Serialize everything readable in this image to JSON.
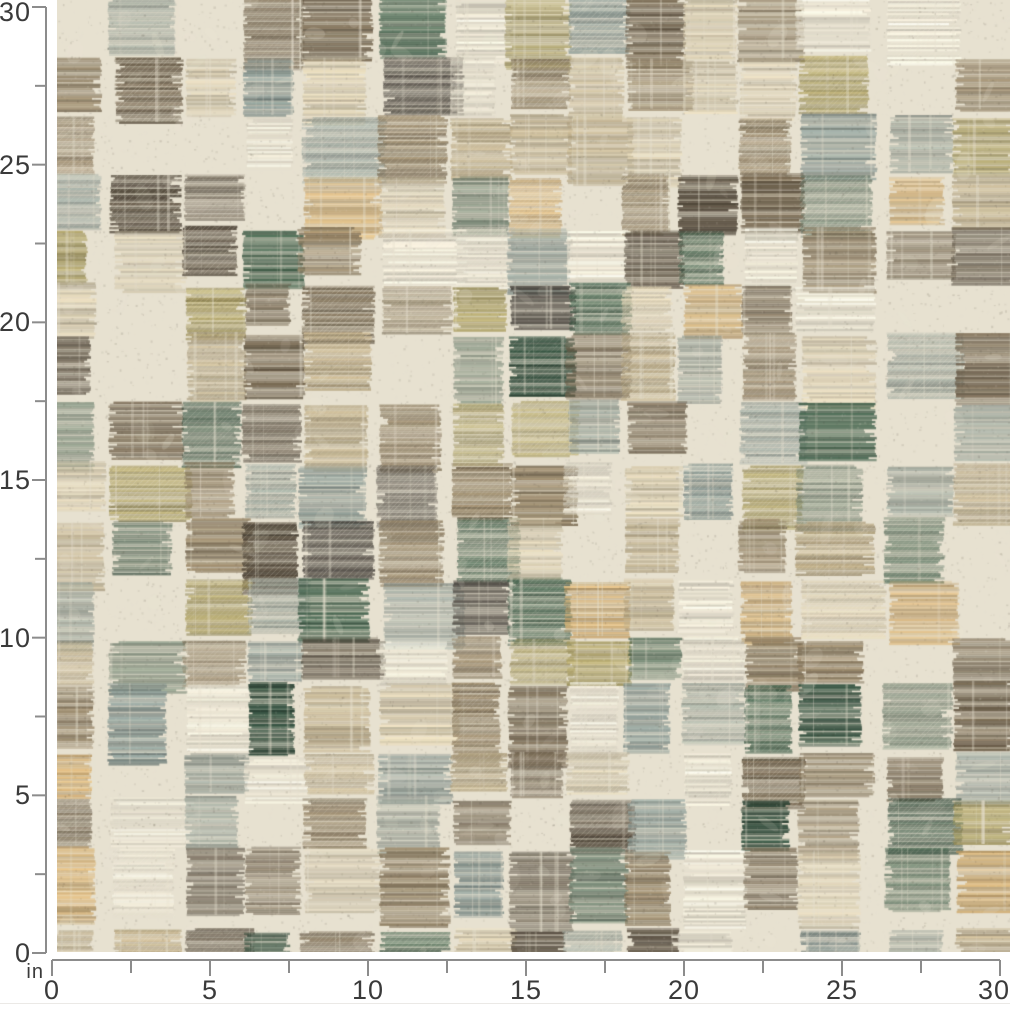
{
  "page": {
    "background": "#ffffff"
  },
  "rulers": {
    "unit_label": "in",
    "min_in": 0,
    "max_in": 30,
    "major_step_in": 5,
    "minor_step_in": 2.5,
    "vertical_labels": [
      "0",
      "5",
      "10",
      "15",
      "20",
      "25",
      "30"
    ],
    "horizontal_labels": [
      "0",
      "5",
      "10",
      "15",
      "20",
      "25",
      "30"
    ],
    "line_color": "#8c8c8c",
    "label_color": "#3a3a3a"
  },
  "swatch": {
    "description": "Distressed abstract patchwork brushstroke upholstery fabric swatch in cream, tan, gold, olive, brown, charcoal, slate blue-gray and forest green",
    "width_in": 30,
    "height_in": 30,
    "base_color": "#e7e1d0",
    "speckle_dark": "#3f382d",
    "speckle_light": "#f3eddd",
    "wear_color": "#eee8d7",
    "seed": 7,
    "palette": [
      {
        "name": "cream",
        "hex": "#e8e2d1",
        "weight": 12
      },
      {
        "name": "light-tan",
        "hex": "#cfc3a6",
        "weight": 8
      },
      {
        "name": "tan",
        "hex": "#b5a582",
        "weight": 10
      },
      {
        "name": "golden-tan",
        "hex": "#c9a76f",
        "weight": 6
      },
      {
        "name": "olive-gold",
        "hex": "#a3975c",
        "weight": 7
      },
      {
        "name": "brown",
        "hex": "#8a7a5f",
        "weight": 12
      },
      {
        "name": "dark-brown",
        "hex": "#6b5d48",
        "weight": 10
      },
      {
        "name": "deep-brown",
        "hex": "#544a3c",
        "weight": 6
      },
      {
        "name": "charcoal",
        "hex": "#4b463f",
        "weight": 4
      },
      {
        "name": "gray-green",
        "hex": "#97a096",
        "weight": 6
      },
      {
        "name": "slate-blue",
        "hex": "#84938e",
        "weight": 7
      },
      {
        "name": "sage",
        "hex": "#6e7f6e",
        "weight": 4
      },
      {
        "name": "dark-green",
        "hex": "#3c5a46",
        "weight": 5
      },
      {
        "name": "forest-green",
        "hex": "#2b4737",
        "weight": 3
      }
    ]
  }
}
